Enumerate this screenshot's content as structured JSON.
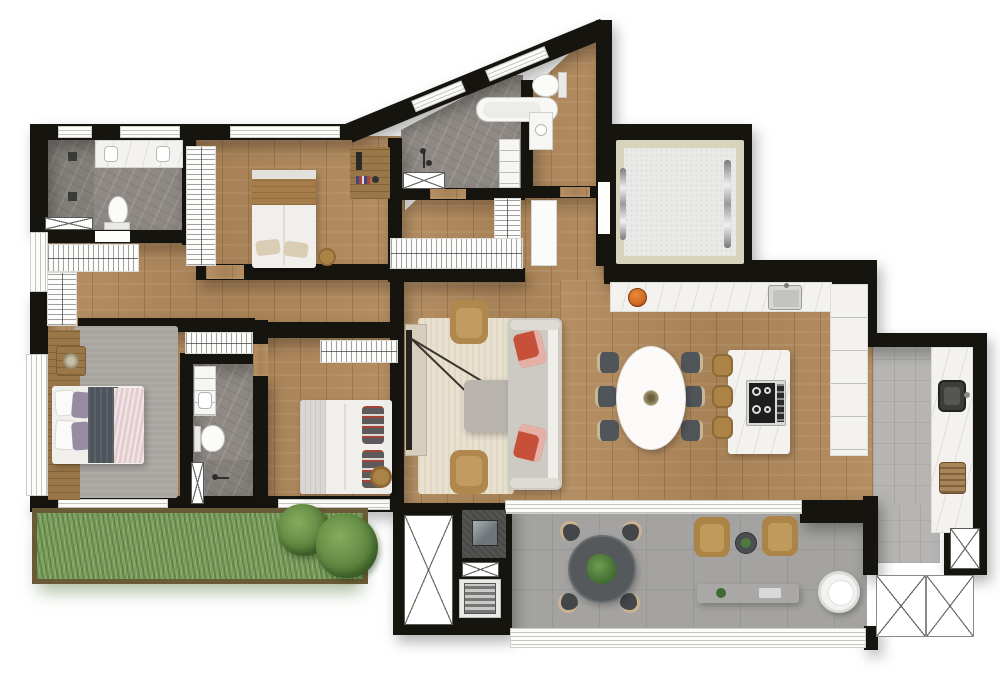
{
  "app": {
    "type": "architectural-floor-plan",
    "description": "Top-down rendered apartment floor plan with three bedrooms, three bathrooms, lavabo, open kitchen and dining, living room, gourmet balcony with grill, service area, elevator and garden planter. No text labels are rendered in the image.",
    "visible_text": []
  },
  "palette": {
    "wall": "#16140f",
    "wood": "#b28a5c",
    "wood_dark": "#9a7748",
    "marble_gray": "#8e8984",
    "marble_white": "#f3f2ef",
    "balcony_floor": "#a4a3a1",
    "service_floor": "#b6b5b3",
    "rug_living": "#e9e1d0",
    "rug_master": "#a9a6a1",
    "sofa": "#cdcac3",
    "accent_pillow": "#c6503a",
    "chair_dark": "#50555a",
    "stool_tan": "#ac8347",
    "bed_white": "#f0efec",
    "duvet_dark": "#4e545b",
    "blanket_pink": "#e4cdd0",
    "pillow_purple": "#978ca2",
    "grass": "#7da05f",
    "bush": "#527a38",
    "soil": "#6b5a37",
    "elevator_frame": "#d8d4bb",
    "elevator_floor": "#e9e9e7",
    "steel": "#d9d9d7",
    "fruit_orange": "#d2691e",
    "table_dark": "#55595b",
    "grill_dark": "#4a4a48"
  },
  "rooms": [
    {
      "id": "bathroom-top-left",
      "floor": "gray-marble",
      "furniture": [
        "double-vanity",
        "toilet",
        "shower-drains",
        "hatched-bench"
      ]
    },
    {
      "id": "walk-in-closet",
      "floor": "wood",
      "furniture": [
        "hanger-rack-horizontal",
        "hanger-rack-vertical"
      ]
    },
    {
      "id": "bedroom-top",
      "floor": "wood",
      "furniture": [
        "double-bed",
        "hanger-rack",
        "desk",
        "pouf"
      ]
    },
    {
      "id": "bathroom-diagonal",
      "floor": "gray-marble",
      "furniture": [
        "bathtub",
        "shower-taps",
        "hatched-bench",
        "cabinet"
      ]
    },
    {
      "id": "lavabo",
      "floor": "wood",
      "furniture": [
        "toilet",
        "vanity",
        "door-panel"
      ]
    },
    {
      "id": "hallway",
      "floor": "wood",
      "furniture": [
        "l-shaped-coat-rack"
      ]
    },
    {
      "id": "elevator",
      "floor": "elevator-cab",
      "furniture": [
        "silver-door-rails"
      ]
    },
    {
      "id": "kitchen",
      "floor": "wood",
      "furniture": [
        "counter-with-sink",
        "fruit-bowl",
        "island-with-cooktop",
        "bar-stools-x3",
        "tall-cabinets"
      ]
    },
    {
      "id": "dining",
      "floor": "wood",
      "furniture": [
        "oval-table",
        "chairs-x6",
        "centerpiece"
      ]
    },
    {
      "id": "living",
      "floor": "wood",
      "furniture": [
        "rug",
        "sofa",
        "red-pillows-x2",
        "coffee-table",
        "armchairs-x2",
        "arc-floor-lamp",
        "tv-console"
      ]
    },
    {
      "id": "master-bedroom",
      "floor": "wood",
      "furniture": [
        "double-bed",
        "headboard-panel",
        "side-table",
        "rug",
        "hanger-rack"
      ]
    },
    {
      "id": "master-bathroom",
      "floor": "gray-marble",
      "furniture": [
        "vanity",
        "toilet",
        "shower-with-door"
      ]
    },
    {
      "id": "bedroom-middle",
      "floor": "wood",
      "furniture": [
        "double-bed",
        "hanger-rack",
        "pouf"
      ]
    },
    {
      "id": "balcony-terrace",
      "floor": "concrete",
      "furniture": [
        "round-table",
        "chairs-x4",
        "plant-centerpiece",
        "lounge-chairs-x2",
        "side-table",
        "planter-bench",
        "egg-chair",
        "grill-station",
        "grill-grate",
        "duct-shafts"
      ]
    },
    {
      "id": "service-area",
      "floor": "gray-tile",
      "furniture": [
        "laundry-sink",
        "laundry-basket",
        "counter",
        "technical-shafts"
      ]
    },
    {
      "id": "garden-planter",
      "floor": "grass",
      "furniture": [
        "bush-small",
        "bush-large"
      ]
    }
  ]
}
